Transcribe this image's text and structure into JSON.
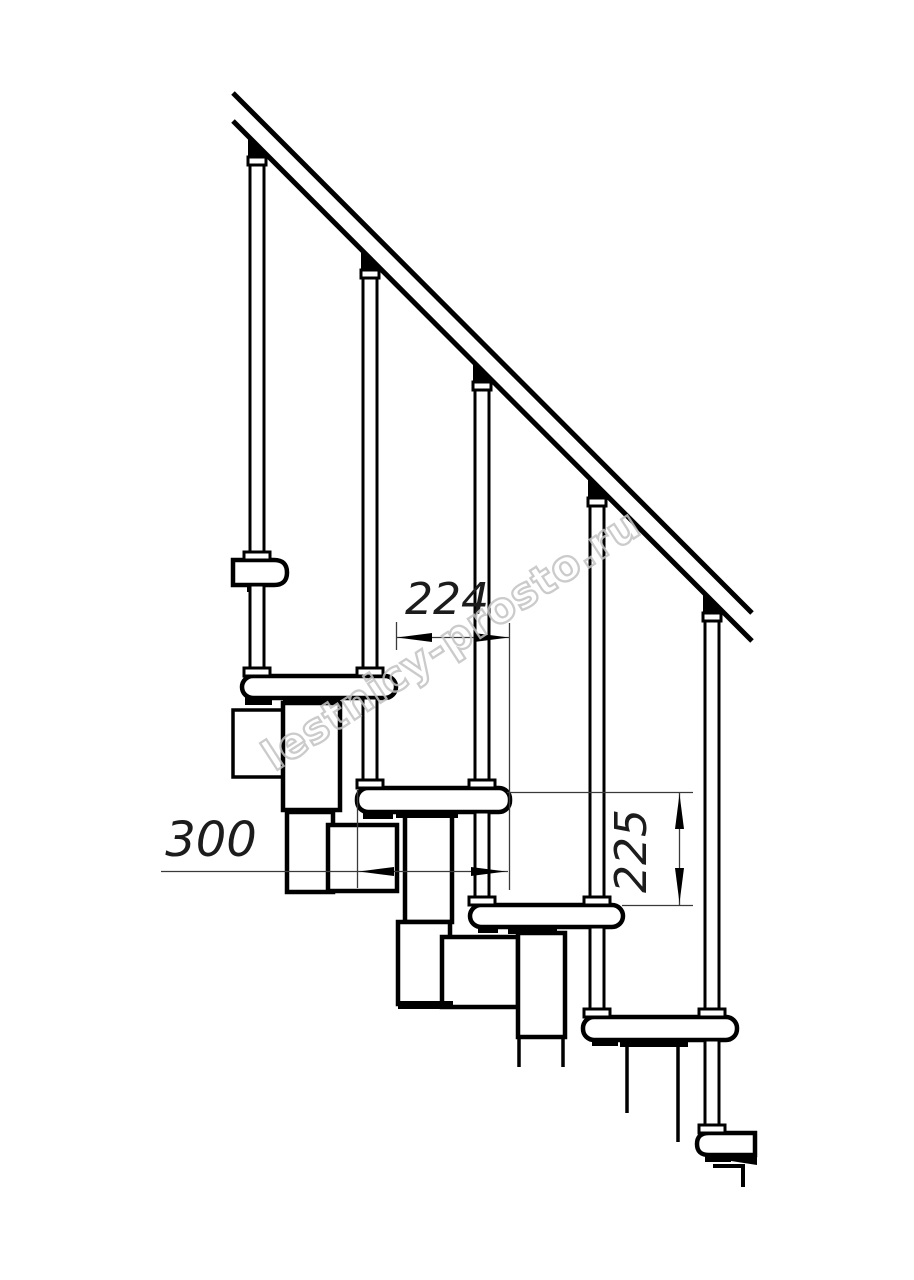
{
  "drawing": {
    "description": "Modular staircase side elevation, technical line drawing",
    "treads_visible": 6,
    "balusters_visible": 5
  },
  "dimensions": {
    "step_going": {
      "value": "224"
    },
    "tread_depth": {
      "value": "300"
    },
    "riser_height": {
      "value": "225"
    }
  },
  "watermark": {
    "text": "lestnicy-prosto.ru"
  },
  "colors": {
    "line": "#000000",
    "background": "#ffffff",
    "thin_line": "#3a3a3a",
    "dim_text": "#1c1c1c",
    "watermark": "#c2c2c2"
  }
}
